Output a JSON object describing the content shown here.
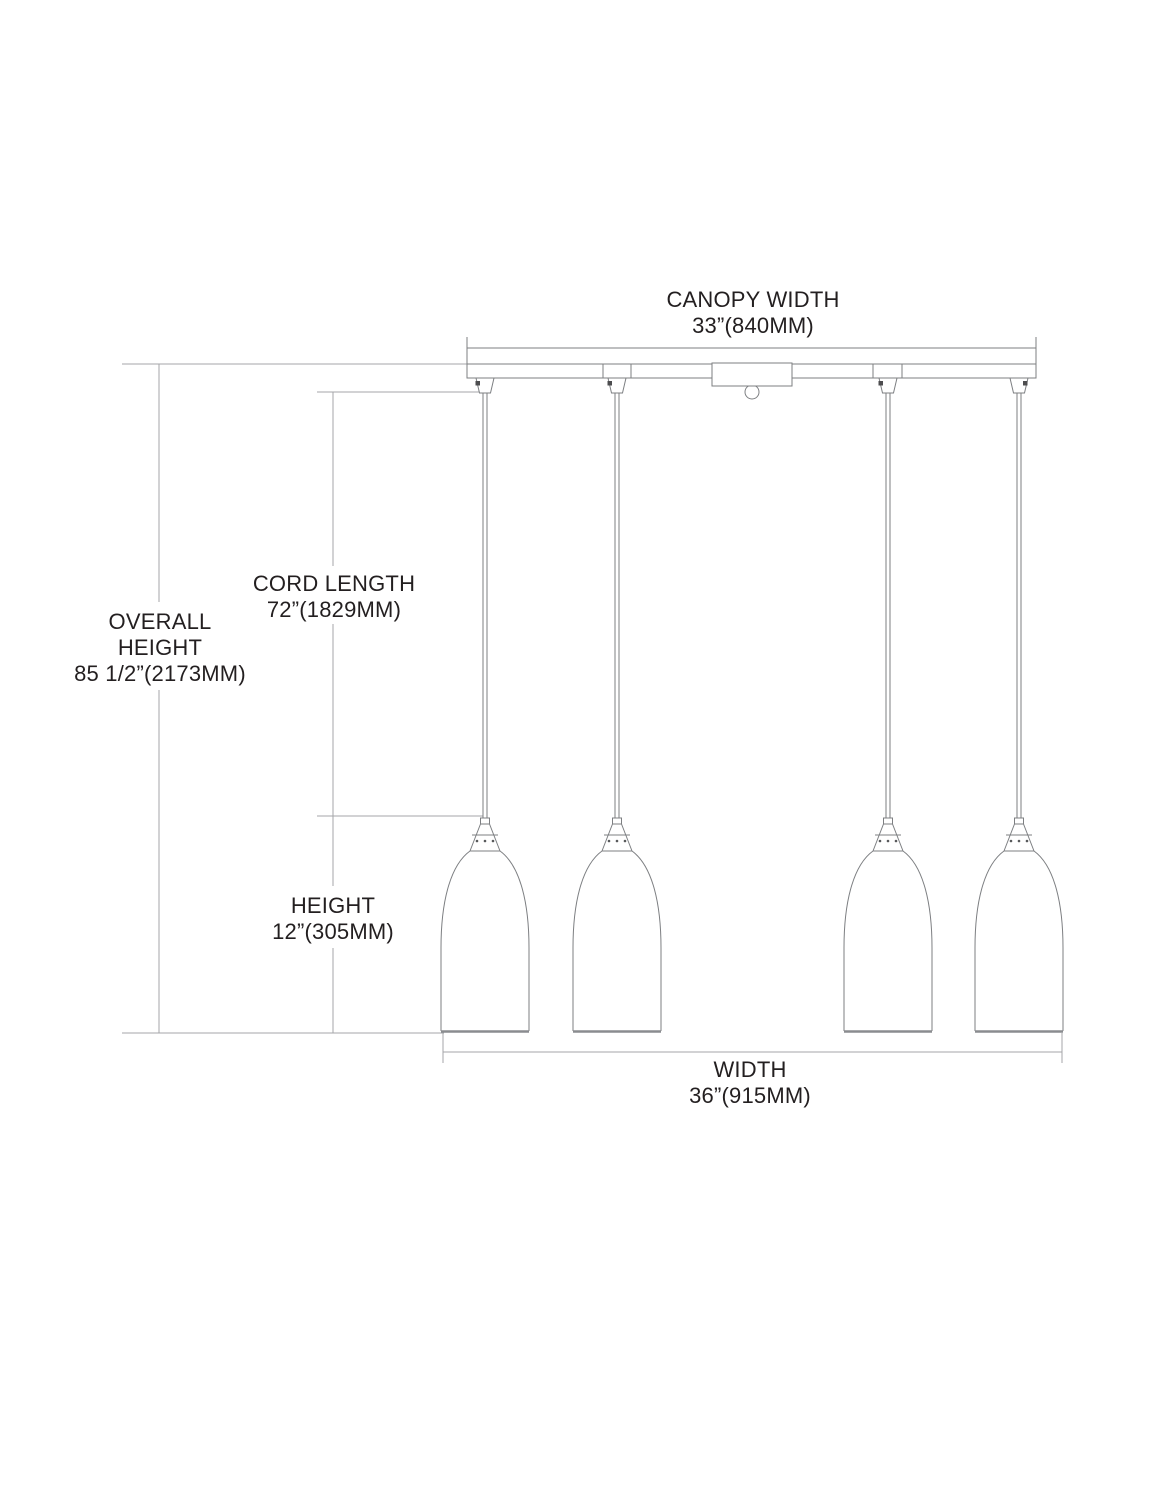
{
  "diagram": {
    "type": "pendant-light-dimension-drawing",
    "pendant_count": 4,
    "dimensions": {
      "canopy_width": {
        "label": "CANOPY WIDTH",
        "value": "33”(840MM)"
      },
      "cord_length": {
        "label": "CORD LENGTH",
        "value": "72”(1829MM)"
      },
      "overall_height": {
        "label_line_1": "OVERALL",
        "label_line_2": "HEIGHT",
        "value": "85 1/2”(2173MM)"
      },
      "height": {
        "label": "HEIGHT",
        "value": "12”(305MM)"
      },
      "width": {
        "label": "WIDTH",
        "value": "36”(915MM)"
      }
    },
    "colors": {
      "background": "#ffffff",
      "drawing_line": "#7d7f82",
      "dimension_line": "#a4a6a9",
      "text": "#231f20"
    }
  }
}
